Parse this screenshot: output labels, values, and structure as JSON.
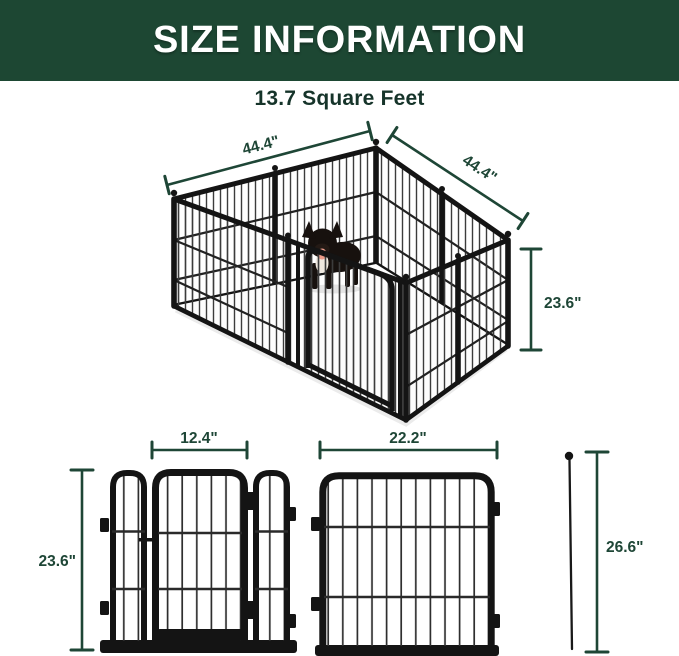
{
  "header": {
    "title": "SIZE INFORMATION",
    "bg_color": "#1d4733",
    "title_color": "#ffffff"
  },
  "subtitle": {
    "text": "13.7 Square Feet",
    "color": "#16342a"
  },
  "colors": {
    "dimension_green": "#1e4636",
    "metal_frame": "#141414",
    "floor_mat": "#fdfdfd",
    "dog_tongue": "#ea9a88"
  },
  "pen3d": {
    "dim_back_left_width": "44.4\"",
    "dim_back_right_width": "44.4\"",
    "dim_panel_height": "23.6\""
  },
  "panels2d": {
    "door_group": {
      "dim_height": "23.6\"",
      "dim_door_width": "12.4\""
    },
    "single_panel": {
      "dim_width": "22.2\""
    },
    "ground_stake": {
      "dim_length": "26.6\""
    }
  }
}
